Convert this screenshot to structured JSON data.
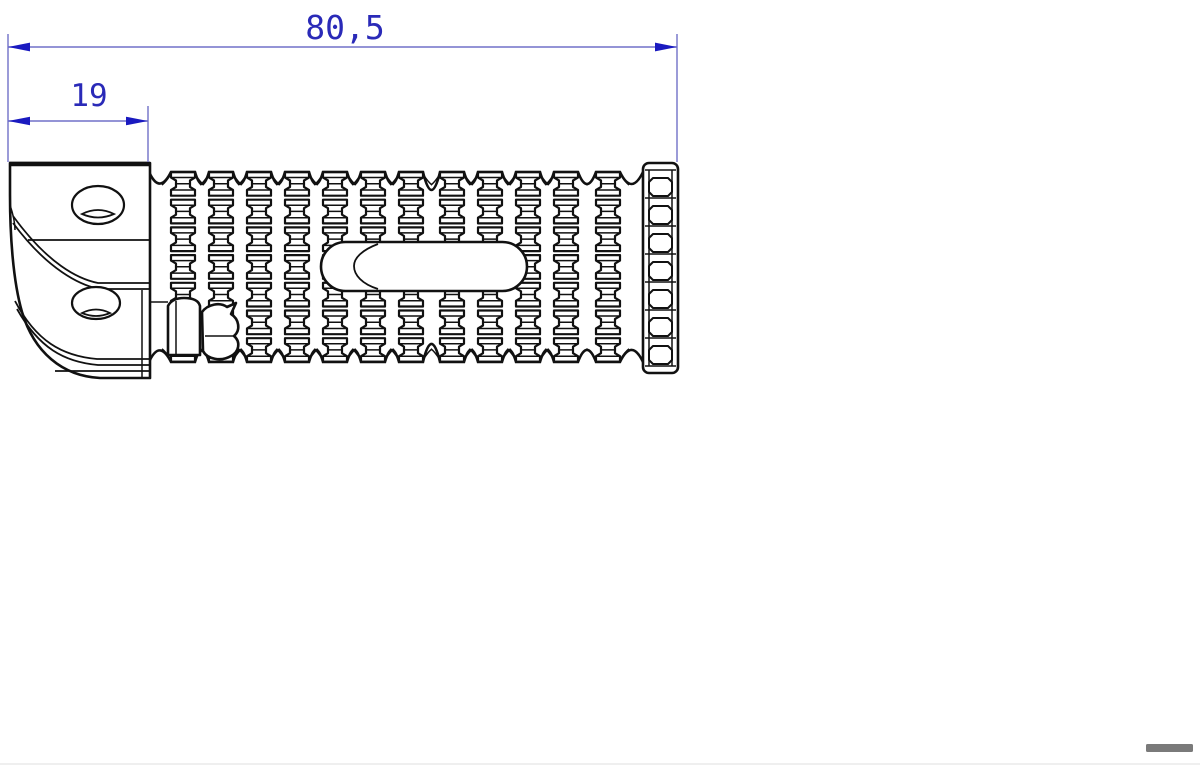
{
  "dimensions": {
    "overall_length": "80,5",
    "bracket_width": "19"
  },
  "colors": {
    "dimension_text": "#2a2ab8",
    "dimension_line": "#7070c8",
    "dimension_arrow": "#1a1ac0",
    "outline": "#111111",
    "scrollbar_thumb": "#7a7a7a",
    "background": "#ffffff"
  }
}
